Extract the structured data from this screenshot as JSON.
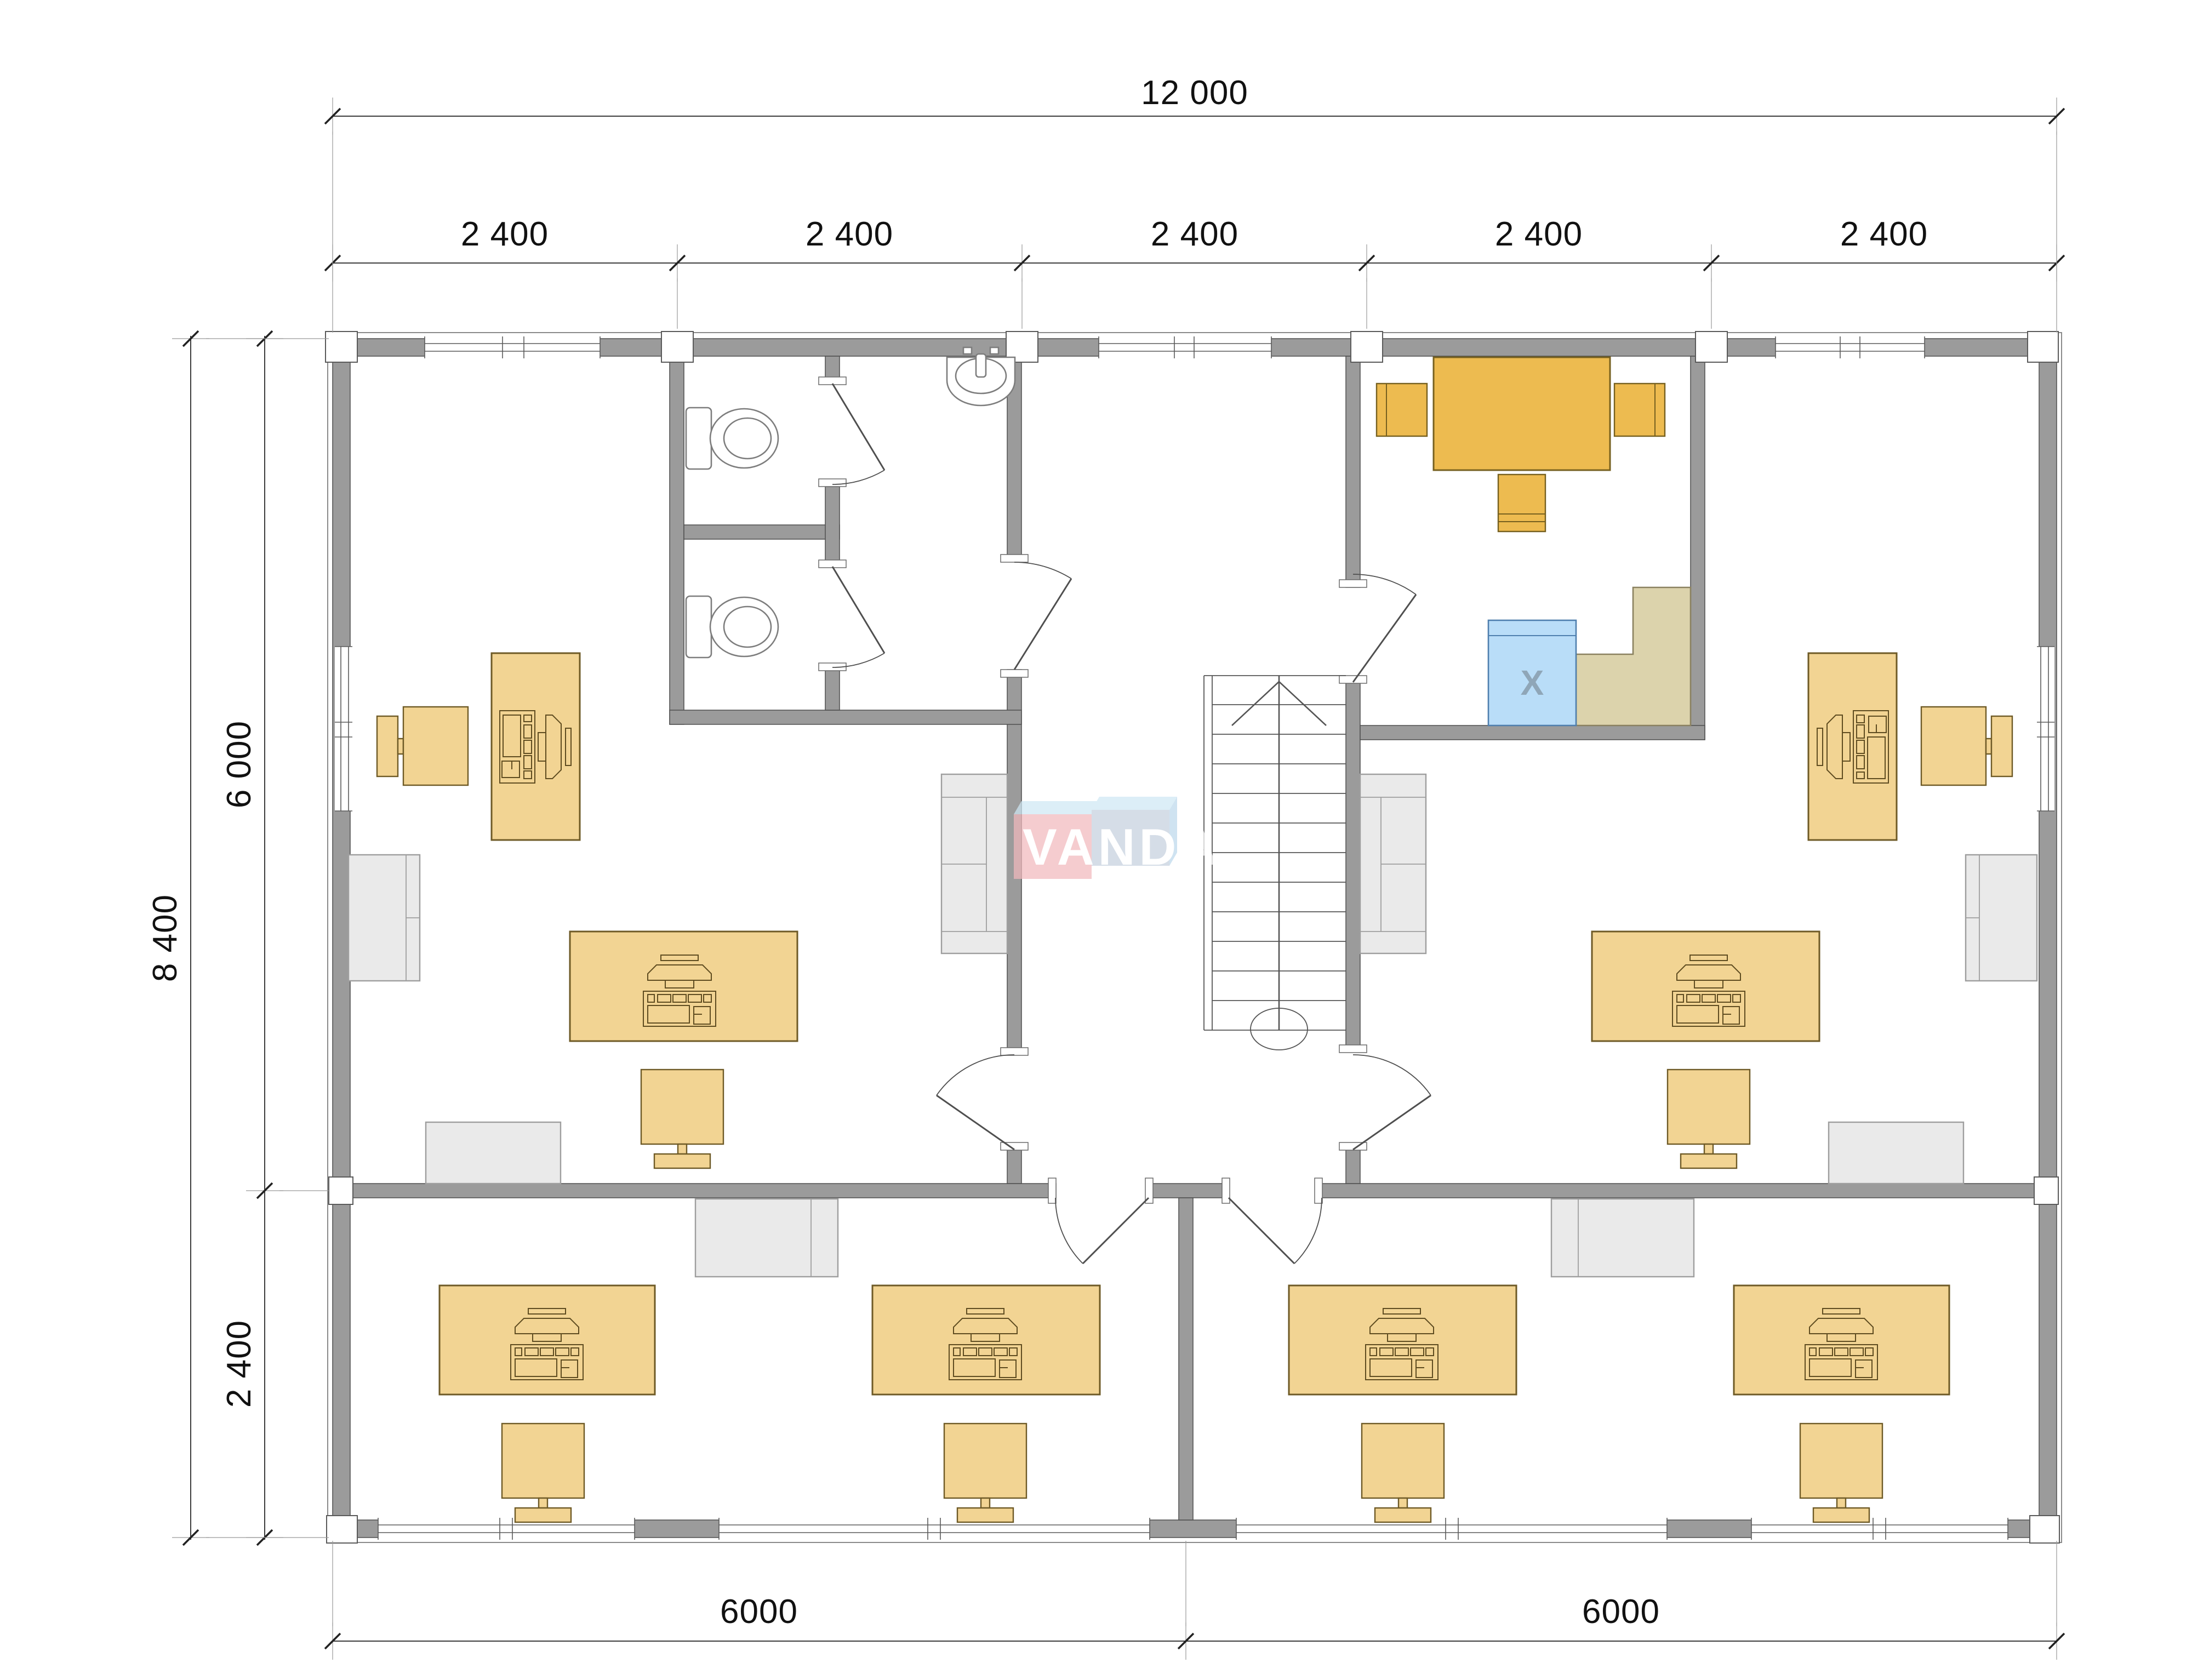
{
  "drawing": {
    "type": "office-floor-plan",
    "watermark": {
      "text": "VANDA"
    },
    "appliance": {
      "label": "X"
    }
  },
  "dimensions": {
    "top_total": "12 000",
    "top_segments": [
      "2 400",
      "2 400",
      "2 400",
      "2 400",
      "2 400"
    ],
    "left_total": "8 400",
    "left_upper": "6 000",
    "left_lower": "2 400",
    "bottom_left": "6000",
    "bottom_right": "6000"
  },
  "colors": {
    "wall": "#9b9b9b",
    "wall-line": "#4f4f4f",
    "desk": "#f2d493",
    "desk-line": "#6e5a26",
    "table": "#edbb50",
    "table-line": "#76601f",
    "counter": "#dcd3ac",
    "counter-line": "#8a8160",
    "appliance": "#b9ddf8",
    "appliance-line": "#4f7fae",
    "gray-furn": "#eaeaea",
    "gray-furn-line": "#9e9e9e",
    "fixture": "#7d7d7d",
    "dim": "#3c3c3c",
    "wm-pink": "#f2b9bd",
    "wm-blue": "#c5d1de",
    "wm-top": "#cfe8f4",
    "wm-side": "#bdd9ec"
  }
}
